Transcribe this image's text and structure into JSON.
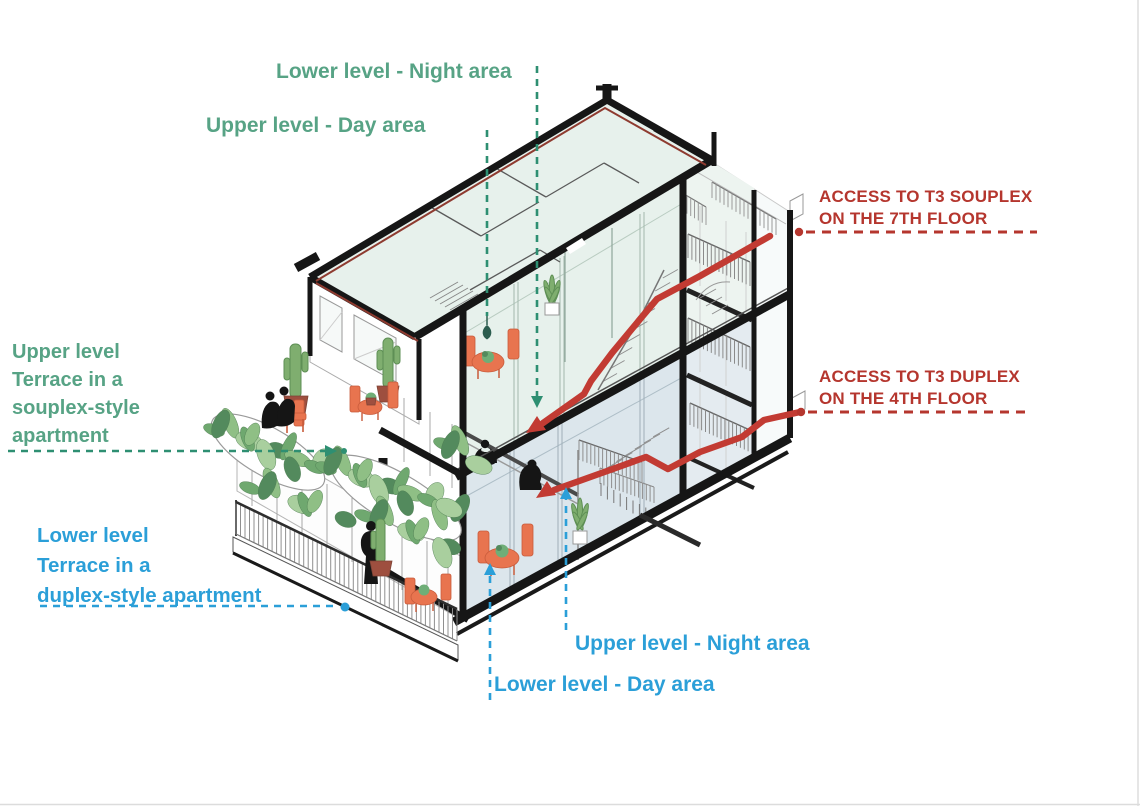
{
  "title": "Axonometric section of duplex and souplex apartments",
  "colors": {
    "green": "#57A385",
    "greenLine": "#2E8F72",
    "greenDark": "#2C5D4F",
    "blue": "#2B9FD8",
    "red": "#B5362E",
    "redPath": "#C23B33",
    "orange": "#E8744F",
    "orangeDark": "#C85B3B",
    "mint": "#E7F1EC",
    "mintLight": "#EDF4F0",
    "lower": "#DCE6EC",
    "lowerLight": "#E4EBF0",
    "wall": "#161616"
  },
  "annotations": {
    "night_area": {
      "text": "Lower level - Night area"
    },
    "day_area": {
      "text": "Upper level - Day area"
    },
    "souplex_terrace": {
      "lines": [
        "Upper level",
        "Terrace in a",
        "souplex-style",
        "apartment"
      ]
    },
    "duplex_terrace": {
      "lines": [
        "Lower level",
        "Terrace in a",
        "duplex-style apartment"
      ]
    },
    "access_souplex": {
      "lines": [
        "ACCESS TO T3 SOUPLEX",
        "ON THE 7TH FLOOR"
      ]
    },
    "access_duplex": {
      "lines": [
        "ACCESS TO T3 DUPLEX",
        "ON THE 4TH FLOOR"
      ]
    },
    "upper_night": {
      "text": "Upper level - Night area"
    },
    "lower_day": {
      "text": "Lower level - Day area"
    }
  }
}
